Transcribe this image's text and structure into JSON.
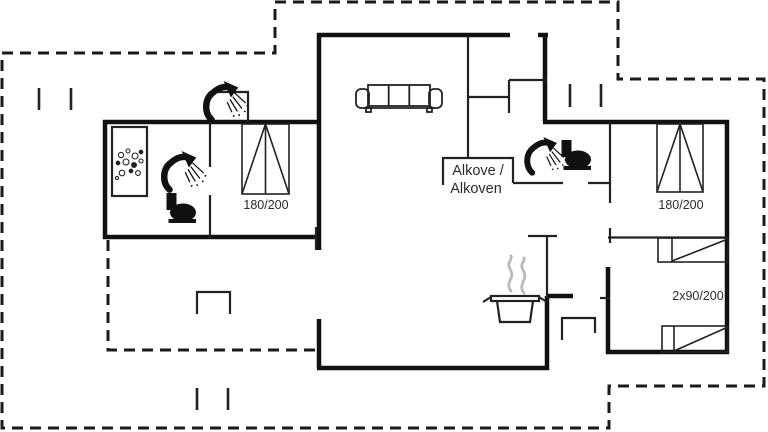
{
  "floorplan": {
    "kind": "holiday-home floor plan",
    "labels": {
      "alcove_line1": "Alkove /",
      "alcove_line2": "Alkoven",
      "bed_left_size": "180/200",
      "bed_right_size": "180/200",
      "twin_beds_size": "2x90/200"
    },
    "icons": [
      "sofa-icon",
      "shower-icon",
      "toilet-icon",
      "sink-icon",
      "stove-pot-icon",
      "steam-icon",
      "double-bed-symbol",
      "single-bed-symbol",
      "entrance-steps",
      "window-marker"
    ],
    "colors": {
      "wall": "#111111",
      "interior_line": "#222222",
      "dashed_boundary": "#1a1a1a",
      "steam": "#b9b9b9",
      "text": "#2b2b2b",
      "background": "#ffffff"
    }
  }
}
